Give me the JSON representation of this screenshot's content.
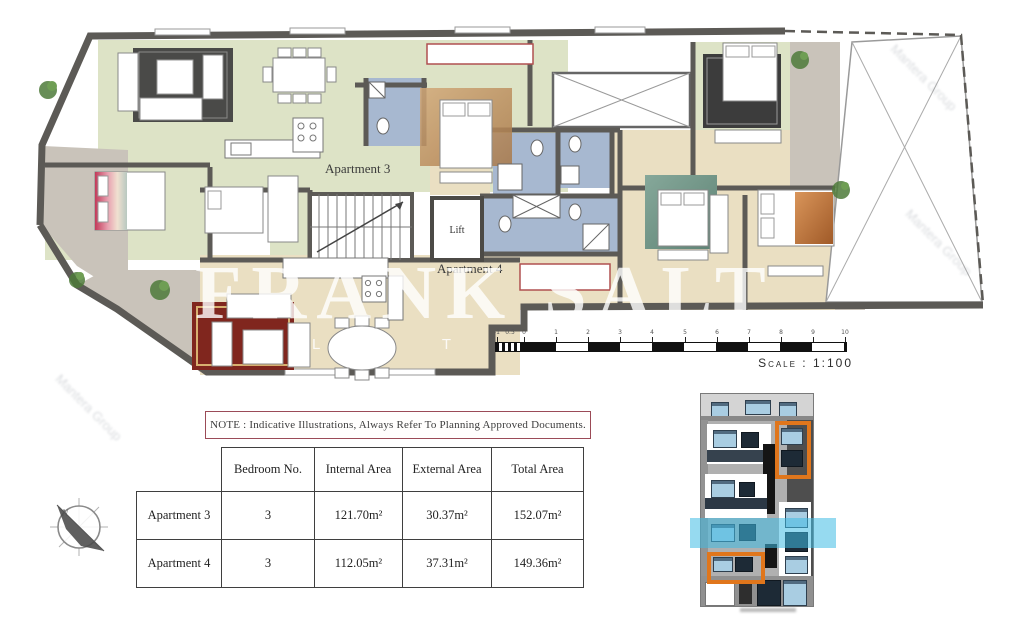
{
  "plan": {
    "apartment3_label": "Apartment 3",
    "apartment4_label": "Apartment 4",
    "lift_label": "Lift"
  },
  "watermark": {
    "main": "FRANK SALT",
    "sub": "L E T",
    "corner_text": "Mantera Group"
  },
  "compass": {
    "north_label": "N"
  },
  "scalebar": {
    "ticks": [
      "-1",
      "0.5",
      "0",
      "1",
      "2",
      "3",
      "4",
      "5",
      "6",
      "7",
      "8",
      "9",
      "10"
    ],
    "label": "Scale : 1:100"
  },
  "note": {
    "text": "NOTE : Indicative Illustrations, Always Refer To Planning Approved Documents."
  },
  "table": {
    "headers": [
      "Bedroom No.",
      "Internal Area",
      "External Area",
      "Total Area"
    ],
    "rows": [
      {
        "name": "Apartment 3",
        "bedroom_no": "3",
        "internal_area": "121.70m²",
        "external_area": "30.37m²",
        "total_area": "152.07m²"
      },
      {
        "name": "Apartment 4",
        "bedroom_no": "3",
        "internal_area": "112.05m²",
        "external_area": "37.31m²",
        "total_area": "149.36m²"
      }
    ]
  },
  "colors": {
    "wall": "#5c5a56",
    "apt3_floor": "#dde3c6",
    "apt4_floor": "#eadfc2",
    "bathroom_floor": "#a7b8d0",
    "terrace": "#c9c3ba",
    "highlight_orange": "#e0761c",
    "highlight_cyan": "#45c0e8",
    "note_border": "#9b4a56"
  }
}
